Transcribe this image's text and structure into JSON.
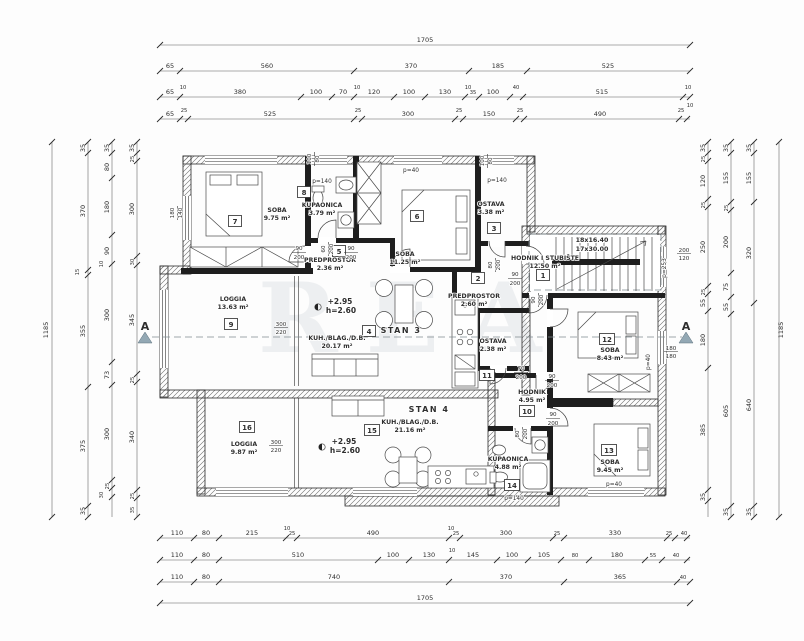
{
  "watermark": {
    "text": "REA"
  },
  "units": {
    "s3": "STAN 3",
    "s4": "STAN 4"
  },
  "level": {
    "e": "+2.95",
    "h": "h=2.60"
  },
  "stairs": {
    "l1": "18x16.40",
    "l2": "17x30.00"
  },
  "section": {
    "label": "A"
  },
  "par": {
    "p40": "p=40",
    "p140": "p=140",
    "p253": "p=253"
  },
  "fr": {
    "f90": [
      "90",
      "200"
    ],
    "f80": [
      "80",
      "200"
    ],
    "f70": [
      "70",
      "200"
    ],
    "f60": [
      "60",
      "200"
    ],
    "f10080": [
      "100",
      "80"
    ],
    "f300": [
      "300",
      "220"
    ],
    "f180": [
      "180",
      "180"
    ],
    "f200": [
      "200",
      "120"
    ],
    "f140": [
      "180",
      "140"
    ]
  },
  "rooms": [
    {
      "num": "1",
      "name": "HODNIK I STUBIŠTE",
      "area": "12.50 m²"
    },
    {
      "num": "2",
      "name": "PREDPROSTOR",
      "area": "2.60 m²"
    },
    {
      "num": "3",
      "name": "OSTAVA",
      "area": "3.38 m²"
    },
    {
      "num": "4",
      "name": "KUH./BLAG./D.B.",
      "area": "20.17 m²"
    },
    {
      "num": "5",
      "name": "PREDPROSTOR",
      "area": "2.36 m²"
    },
    {
      "num": "6",
      "name": "SOBA",
      "area": "11.25 m²"
    },
    {
      "num": "7",
      "name": "SOBA",
      "area": "9.75 m²"
    },
    {
      "num": "8",
      "name": "KUPAONICA",
      "area": "3.79 m²"
    },
    {
      "num": "9",
      "name": "LOGGIA",
      "area": "13.63 m²"
    },
    {
      "num": "10",
      "name": "HODNIK",
      "area": "4.95 m²"
    },
    {
      "num": "11",
      "name": "OSTAVA",
      "area": "2.38 m²"
    },
    {
      "num": "12",
      "name": "SOBA",
      "area": "8.43 m²"
    },
    {
      "num": "13",
      "name": "SOBA",
      "area": "9.45 m²"
    },
    {
      "num": "14",
      "name": "KUPAONICA",
      "area": "4.88 m²"
    },
    {
      "num": "15",
      "name": "KUH./BLAG./D.B.",
      "area": "21.16 m²"
    },
    {
      "num": "16",
      "name": "LOGGIA",
      "area": "9.87 m²"
    }
  ],
  "dims": {
    "top": {
      "total": "1705",
      "r2": [
        "65",
        "560",
        "370",
        "185",
        "525"
      ],
      "r3": [
        "65",
        "10",
        "380",
        "100",
        "70",
        "120",
        "100",
        "130",
        "35",
        "100",
        "40",
        "515",
        "10"
      ],
      "r4": [
        "65",
        "25",
        "525",
        "25",
        "300",
        "25",
        "150",
        "25",
        "490",
        "25",
        "10"
      ]
    },
    "bottom": {
      "total": "1705",
      "r1": [
        "110",
        "80",
        "215",
        "25",
        "490",
        "25",
        "300",
        "25",
        "330",
        "25",
        "40",
        "10",
        "10"
      ],
      "r2": [
        "110",
        "80",
        "510",
        "100",
        "130",
        "145",
        "100",
        "105",
        "80",
        "180",
        "55",
        "40",
        "10"
      ],
      "r3": [
        "110",
        "80",
        "740",
        "370",
        "365",
        "40"
      ]
    },
    "left": {
      "total": "1185",
      "c1": [
        "35",
        "370",
        "15",
        "355",
        "375",
        "35"
      ],
      "c2": [
        "35",
        "80",
        "180",
        "90",
        "10",
        "300",
        "73",
        "300",
        "25",
        "30"
      ],
      "c3": [
        "35",
        "25",
        "300",
        "30",
        "345",
        "25",
        "340",
        "25",
        "35"
      ]
    },
    "right": {
      "total": "1185",
      "c1": [
        "35",
        "25",
        "120",
        "25",
        "250",
        "25",
        "55",
        "180",
        "385",
        "35"
      ],
      "c2": [
        "35",
        "155",
        "25",
        "200",
        "75",
        "55",
        "605",
        "35"
      ],
      "c3": [
        "35",
        "155",
        "320",
        "640",
        "35"
      ]
    }
  }
}
